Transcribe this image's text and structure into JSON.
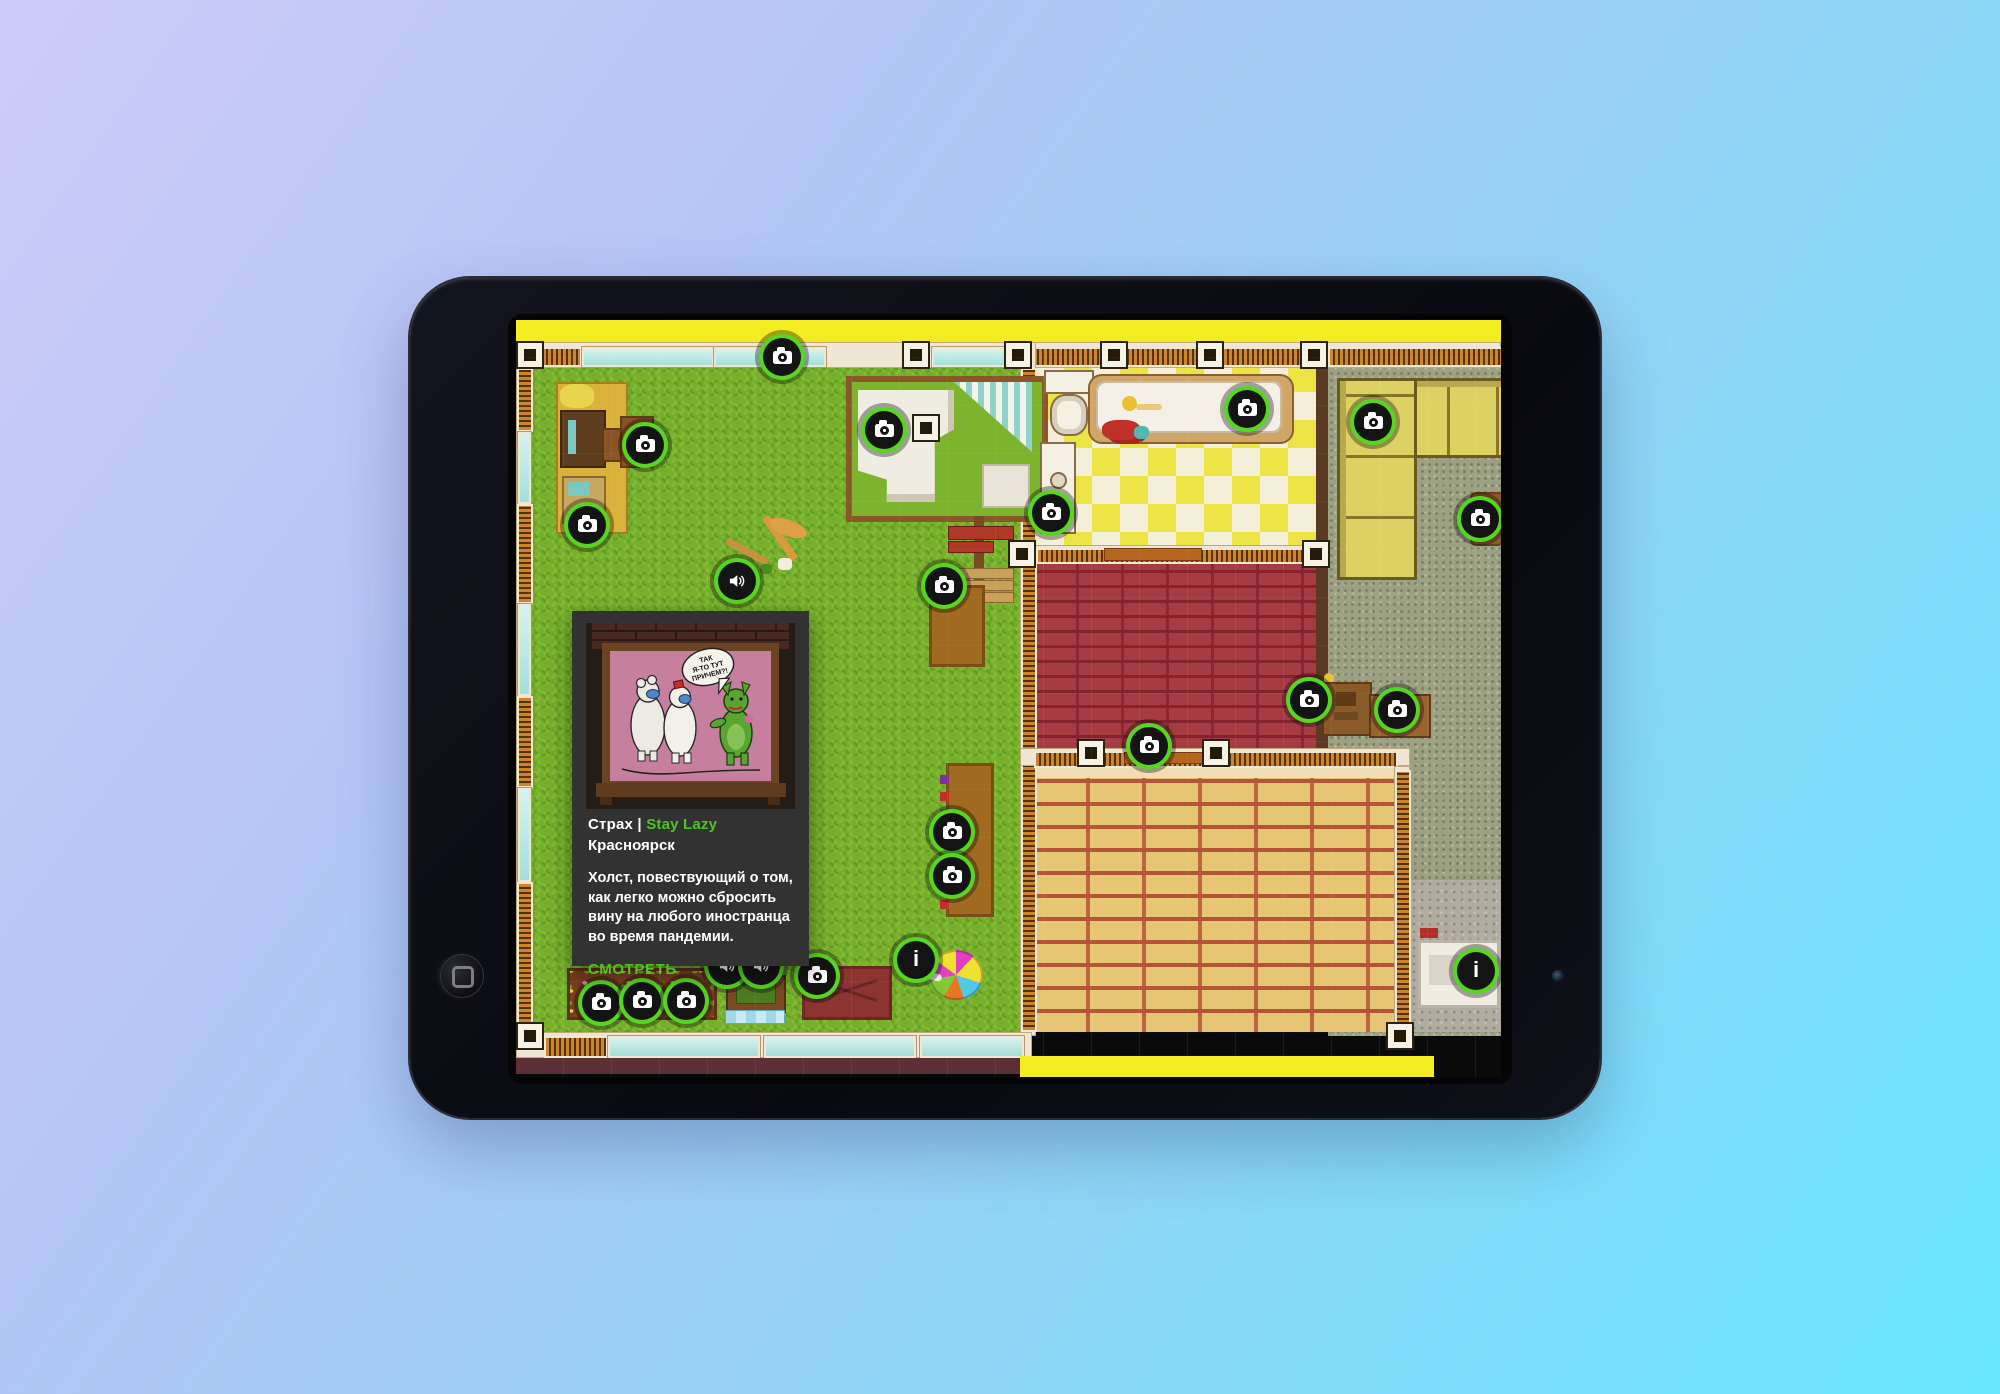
{
  "background": {
    "gradient_from": "#cdccf8",
    "gradient_to": "#68e6fd"
  },
  "icons": {
    "info_glyph": "i"
  },
  "accent": {
    "marker_ring": "#57d621",
    "marker_bg": "#141414",
    "link_green": "#4fc420",
    "popup_bg": "#323232"
  },
  "popup": {
    "title": "Страх",
    "separator": "|",
    "artist": "Stay Lazy",
    "city": "Красноярск",
    "description": "Холст, повествующий о том, как легко можно сбросить вину на любого иностранца во время пандемии.",
    "cta": "СМОТРЕТЬ",
    "artwork": {
      "speech_lines": [
        "ТАК",
        "Я-ТО ТУТ",
        "ПРИЧЕМ?!"
      ]
    }
  },
  "map": {
    "markers": [
      {
        "type": "camera",
        "name": "top-wall",
        "x": 266,
        "y": 37
      },
      {
        "type": "camera",
        "name": "bedroom",
        "x": 368,
        "y": 110
      },
      {
        "type": "camera",
        "name": "desk-table",
        "x": 129,
        "y": 125
      },
      {
        "type": "camera",
        "name": "desk",
        "x": 71,
        "y": 205
      },
      {
        "type": "camera",
        "name": "bathroom-sink",
        "x": 535,
        "y": 193
      },
      {
        "type": "camera",
        "name": "bathtub",
        "x": 731,
        "y": 89
      },
      {
        "type": "camera",
        "name": "couch",
        "x": 857,
        "y": 102
      },
      {
        "type": "camera",
        "name": "armchair",
        "x": 964,
        "y": 199
      },
      {
        "type": "camera",
        "name": "table-top",
        "x": 428,
        "y": 266
      },
      {
        "type": "camera",
        "name": "long-table-upper",
        "x": 436,
        "y": 512
      },
      {
        "type": "camera",
        "name": "long-table-lower",
        "x": 436,
        "y": 556
      },
      {
        "type": "camera",
        "name": "brick-room-wall",
        "x": 633,
        "y": 426
      },
      {
        "type": "camera",
        "name": "dresser-left",
        "x": 793,
        "y": 380
      },
      {
        "type": "camera",
        "name": "dresser-right",
        "x": 881,
        "y": 390
      },
      {
        "type": "camera",
        "name": "flower-bed-1",
        "x": 85,
        "y": 683
      },
      {
        "type": "camera",
        "name": "flower-bed-2",
        "x": 126,
        "y": 681
      },
      {
        "type": "camera",
        "name": "flower-bed-3",
        "x": 170,
        "y": 681
      },
      {
        "type": "camera",
        "name": "red-table",
        "x": 301,
        "y": 656
      },
      {
        "type": "speaker",
        "name": "lawn",
        "x": 221,
        "y": 261
      },
      {
        "type": "speaker",
        "name": "green-table-1",
        "x": 211,
        "y": 646
      },
      {
        "type": "speaker",
        "name": "green-table-2",
        "x": 245,
        "y": 646
      },
      {
        "type": "info",
        "name": "lawn-info",
        "x": 400,
        "y": 640
      },
      {
        "type": "info",
        "name": "corner-info",
        "x": 960,
        "y": 651
      }
    ]
  }
}
